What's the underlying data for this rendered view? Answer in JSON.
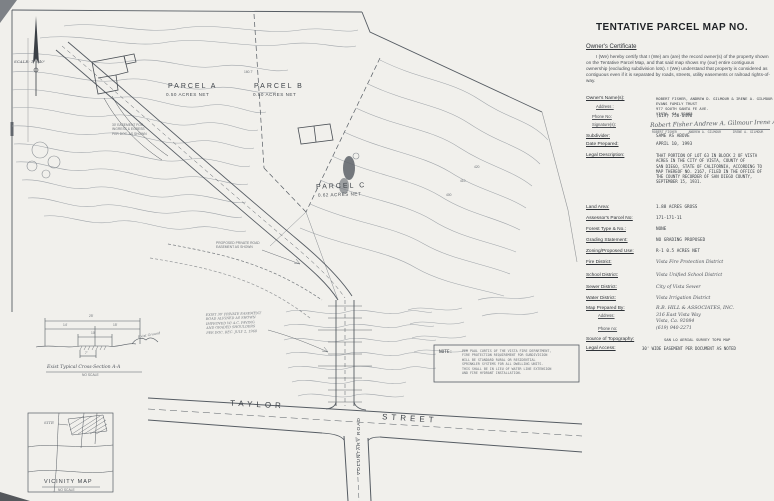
{
  "panel": {
    "title": "TENTATIVE PARCEL MAP NO.",
    "certificate": {
      "heading": "Owner's Certificate",
      "body": "I (We) hereby certify that I (We) am (are) the record owner(s) of the property shown on the Tentative Parcel Map, and that said map shows my (our) entire contiguous ownership (excluding subdivision lots).  I (We) understand that property is considered as contiguous even if it is separated by roads, streets, utility easements or railroad rights-of-way."
    },
    "owner": {
      "label": "Owner's Name(s):",
      "address_label": "Address :",
      "names": "ROBERT FISHER, ANDREW D. GILMOUR & IRENE A. GILMOUR\nEVANS FAMILY TRUST\n977 SOUTH SANTA FE AVE.\nVISTA, CA. 92083",
      "phone_label": "Phone No:",
      "phone": "(619) 758-0490",
      "signature_label": "Signature(s):",
      "signatures_script": "Robert Fisher   Andrew A. Gilmour   Irene A. Gilmour",
      "signatures_printed": "ROBERT FISHER      ANDREW A. GILMOUR      IRENE A. GILMOUR"
    },
    "fields": {
      "subdivider_label": "Subdivider:",
      "subdivider": "SAME AS ABOVE",
      "date_prepared_label": "Date Prepared:",
      "date_prepared": "APRIL 10, 1993",
      "legal_label": "Legal Description:",
      "legal": "THAT PORTION OF LOT 63 IN BLOCK 2 OF VISTA\nACRES IN THE CITY OF VISTA, COUNTY OF\nSAN DIEGO, STATE OF CALIFORNIA, ACCORDING TO\nMAP THEREOF NO. 2167, FILED IN THE OFFICE OF\nTHE COUNTY RECORDER OF SAN DIEGO COUNTY,\nSEPTEMBER 15, 1931.",
      "land_area_label": "Land Area:",
      "land_area": "1.88 ACRES GROSS",
      "apn_label": "Assessor's Parcel No:",
      "apn": "171-171-11",
      "forest_label": "Forest Type & No.:",
      "forest": "NONE",
      "grading_label": "Grading Statement:",
      "grading": "NO GRADING PROPOSED",
      "zoning_label": "Zoning/Proposed Use:",
      "zoning": "R-1  0.5 ACRES NET",
      "fire_label": "Fire District:",
      "fire": "Vista Fire Protection District",
      "school_label": "School District:",
      "school": "Vista Unified School District",
      "sewer_label": "Sewer District:",
      "sewer": "City of Vista Sewer",
      "water_label": "Water District:",
      "water": "Vista Irrigation District",
      "prepared_label": "Map Prepared By:",
      "prepared": "R.B. HILL & ASSOCIATES, INC.",
      "prepared_address_label": "Address:",
      "prepared_address": "316 East Vista Way\nVista, Ca. 92084",
      "prepared_phone_label": "Phone no:",
      "prepared_phone": "(619) 940-2271",
      "topo_label": "Source of Topography:",
      "topo": "SAN LO AERIAL SURVEY TOPO MAP",
      "access_label": "Legal Access:",
      "access": "30' WIDE EASEMENT PER DOCUMENT AS NOTED"
    }
  },
  "map": {
    "scale_label": "SCALE: 1\"=40'",
    "parcel_a_name": "PARCEL A",
    "parcel_a_area": "0.50 ACRES NET",
    "parcel_b_name": "PARCEL B",
    "parcel_b_area": "0.50 ACRES NET",
    "parcel_c_name": "PARCEL C",
    "parcel_c_area": "0.62 ACRES NET",
    "dim_160": "160.7'",
    "street_taylor": "TAYLOR",
    "street_street": "STREET",
    "voluntary_road": "VOLUNTARY ROAD",
    "elev_400": "400",
    "elev_410": "410",
    "elev_420": "420",
    "easement_callout": "PROPOSED PRIVATE ROAD\nEASEMENT AS SHOWN",
    "ingress_note": "30' EASEMENT FOR\nINGRESS & EGRESS\nPER DOC. AS SHOWN",
    "private_road_note": "EXIST 30' PRIVATE EASEMENT\nROAD ALIGNED AS SHOWN\nIMPROVED W/ A.C. PAVING\nAND GRADED SHOULDERS\nPER DOC. REC. JULY 2, 1968",
    "cross_section": {
      "title": "Exist Typical Cross-Section  A-A",
      "scale": "NO SCALE",
      "dim_25": "25'",
      "dim_14": "14'",
      "dim_15": "15'",
      "dim_10": "10'",
      "dim_7": "7'",
      "exist_ground": "Exist Ground"
    },
    "vicinity": {
      "title": "VICINITY MAP",
      "scale": "NO SCALE",
      "site": "SITE"
    },
    "note": {
      "label": "NOTE:",
      "text": "PER PAUL CURTIS OF THE VISTA FIRE DEPARTMENT,\nFIRE PROTECTION REQUIREMENT FOR SUBDIVISION\nWILL BE STANDARD RURAL OR RESIDENTIAL\nSPRINKLER SYSTEMS FOR ALL DWELLING UNITS.\nTHIS SHALL BE IN LIEU OF WATER LINE EXTENSION\nAND FIRE HYDRANT INSTALLATION."
    }
  }
}
